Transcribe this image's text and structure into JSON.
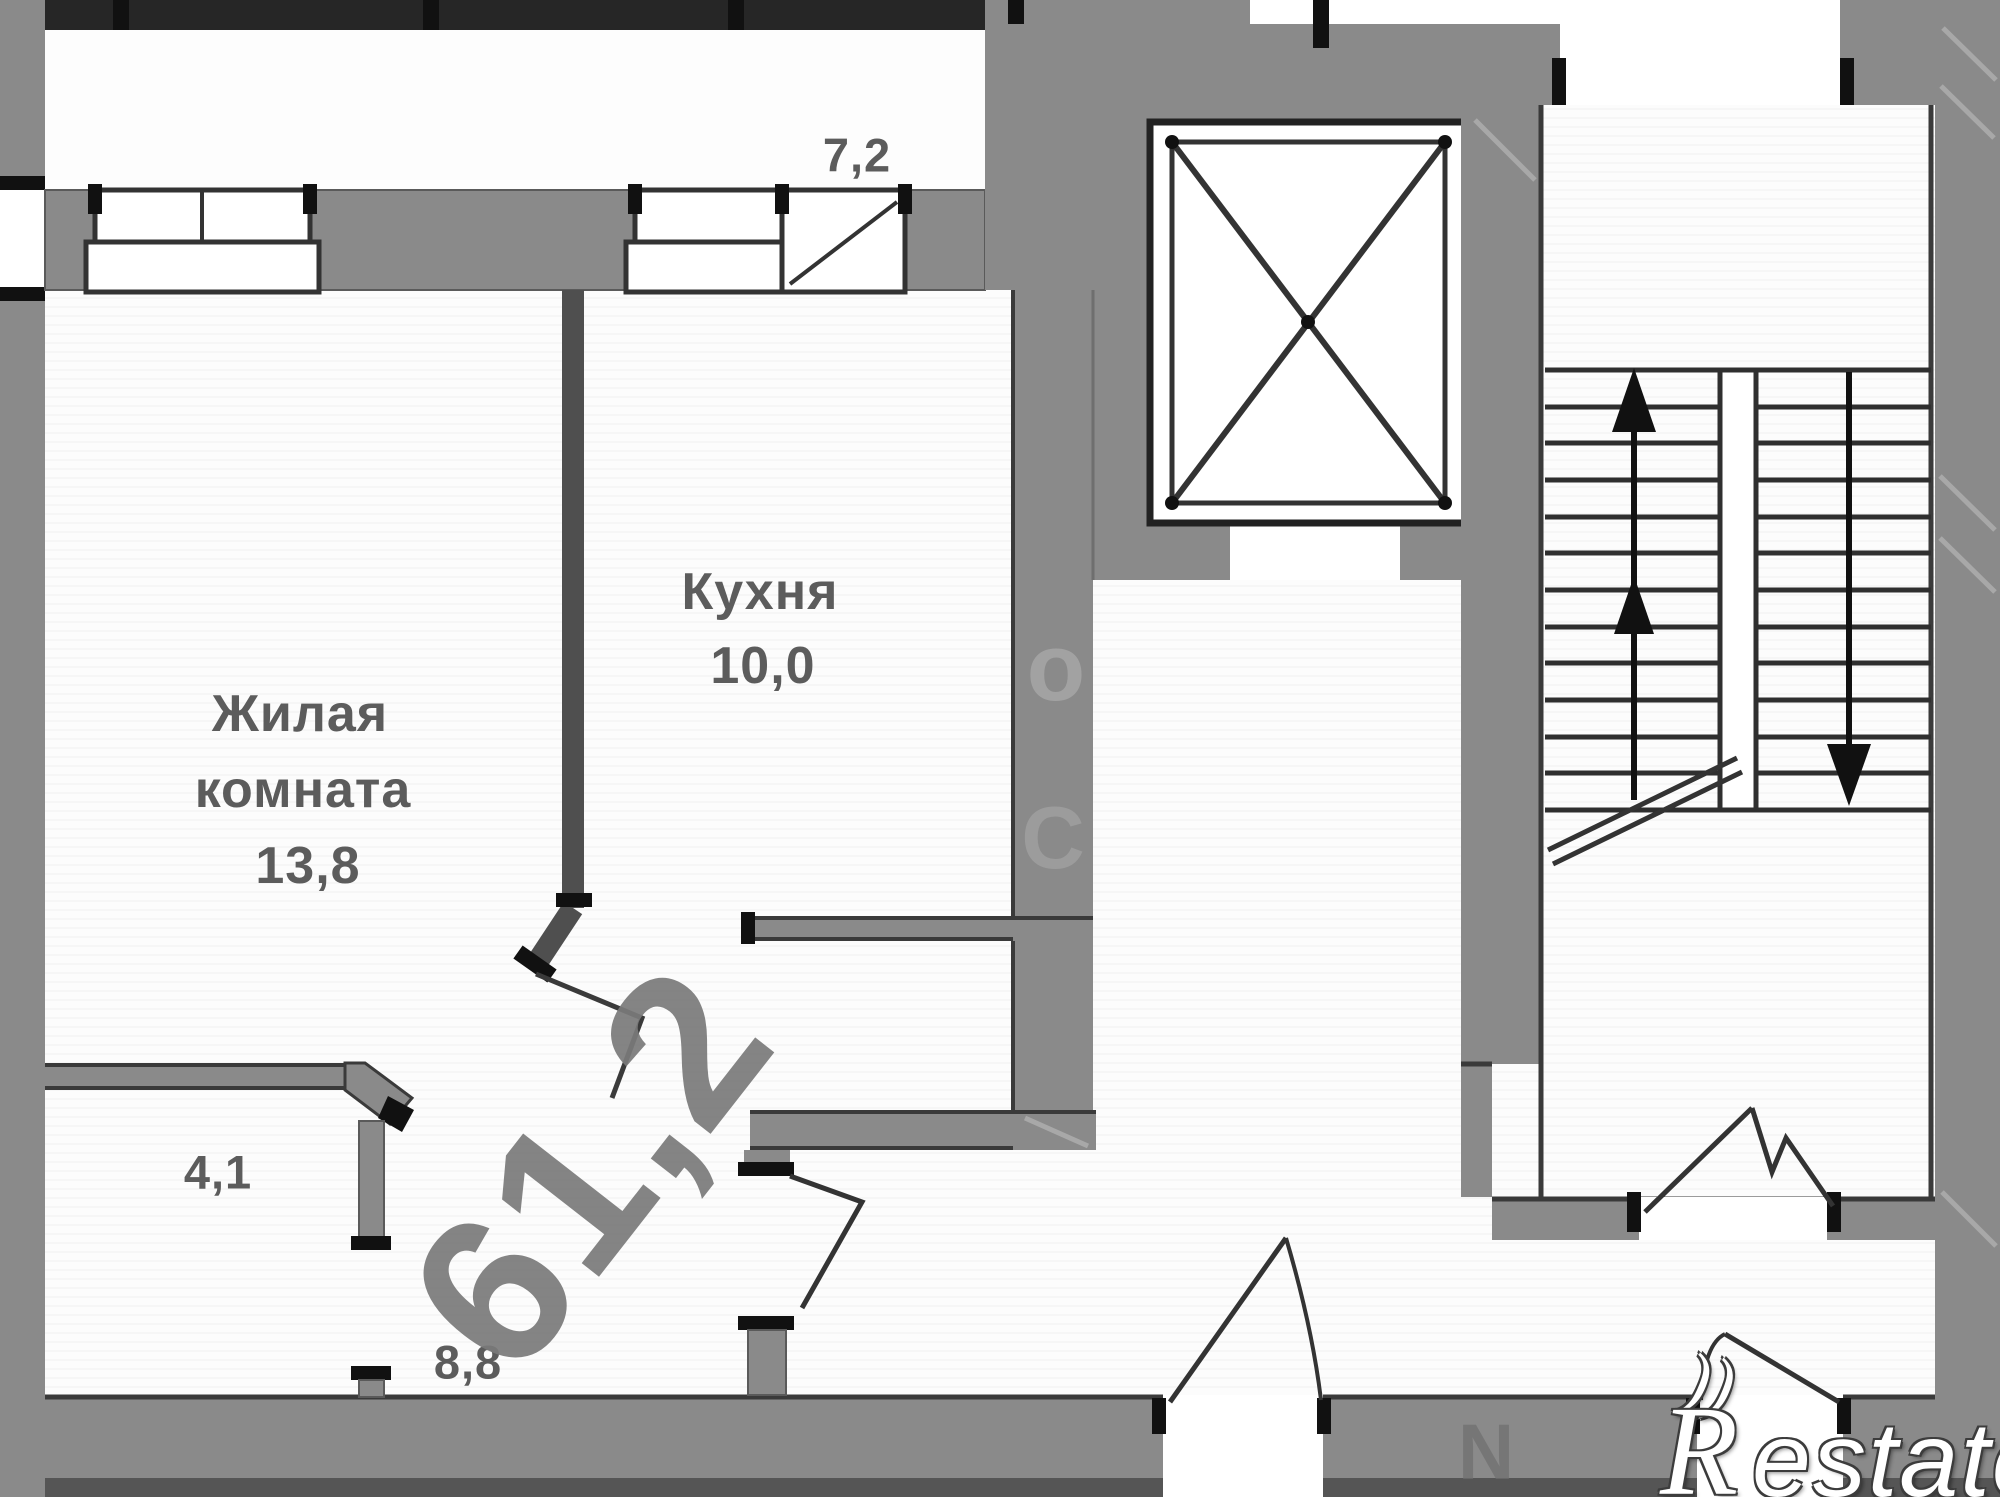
{
  "rooms": {
    "living_room": {
      "name_line1": "Жилая",
      "name_line2": "комната",
      "area": "13,8"
    },
    "kitchen": {
      "name": "Кухня",
      "area": "10,0"
    },
    "balcony": {
      "area": "7,2"
    },
    "bathroom": {
      "area": "4,1"
    },
    "hallway": {
      "area": "8,8"
    }
  },
  "total_area_watermark": "61,2",
  "wall_watermark_fragments": {
    "c": "С",
    "o": "о",
    "n": "N"
  },
  "logo": {
    "curl": "))",
    "initial": "R",
    "rest": "estate"
  },
  "colors": {
    "wall": "#8a8a8a",
    "wall_top_band": "#262626",
    "line": "#3a3a3a",
    "label": "#5c5c5c",
    "area_watermark": "#7a7a7a",
    "logo_fill": "#ffffff",
    "logo_outline": "#3c3c3c"
  }
}
